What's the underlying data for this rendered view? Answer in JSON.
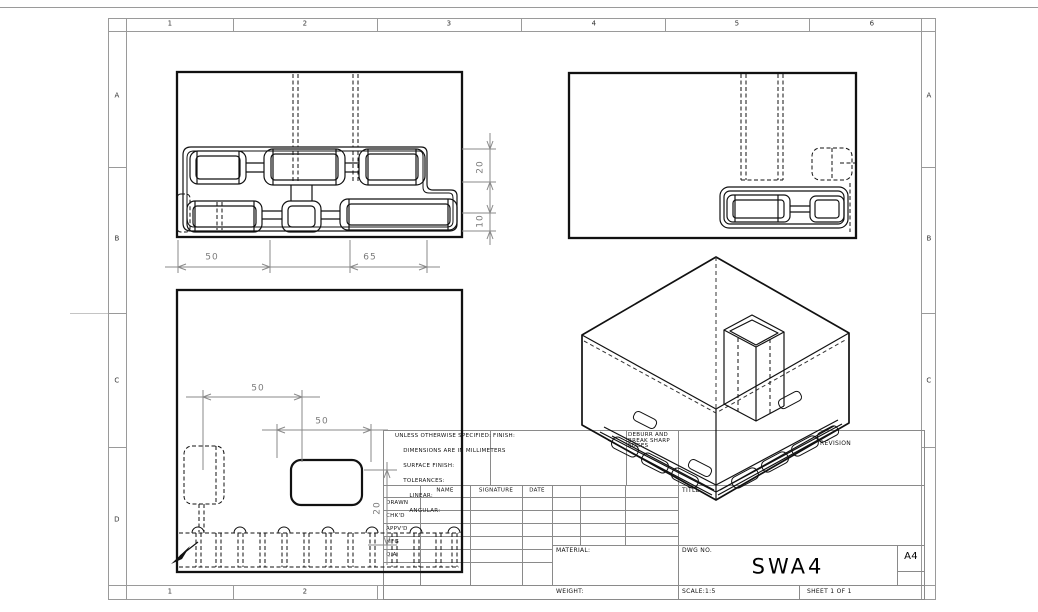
{
  "zones": {
    "columns": [
      "1",
      "2",
      "3",
      "4",
      "5",
      "6"
    ],
    "rows": [
      "A",
      "B",
      "C",
      "D"
    ]
  },
  "notes": {
    "lines": [
      "UNLESS OTHERWISE SPECIFIED:",
      "DIMENSIONS ARE IN MILLIMETERS",
      "SURFACE FINISH:",
      "TOLERANCES:",
      "   LINEAR:",
      "   ANGULAR:"
    ]
  },
  "title_block": {
    "finish_label": "FINISH:",
    "deburr_note": [
      "DEBURR AND",
      "BREAK SHARP",
      "EDGES"
    ],
    "revision_label": "REVISION",
    "title_label": "TITLE:",
    "material_label": "MATERIAL:",
    "weight_label": "WEIGHT:",
    "dwg_no_label": "DWG NO.",
    "drawing_number": "SWA4",
    "paper_size": "A4",
    "scale_label": "SCALE:1:5",
    "sheet_label": "SHEET 1 OF 1",
    "sig_table": {
      "headers": [
        "NAME",
        "SIGNATURE",
        "DATE"
      ],
      "row_labels": [
        "DRAWN",
        "CHK'D",
        "APPV'D",
        "MFG",
        "Q.A"
      ]
    }
  },
  "dimensions": {
    "front_view": {
      "width_left": "50",
      "width_right": "65",
      "slot_height": "20",
      "slot_height_small": "10"
    },
    "plan_view": {
      "offset_upper": "50",
      "offset_lower": "50",
      "vertical_offset": "20"
    }
  }
}
